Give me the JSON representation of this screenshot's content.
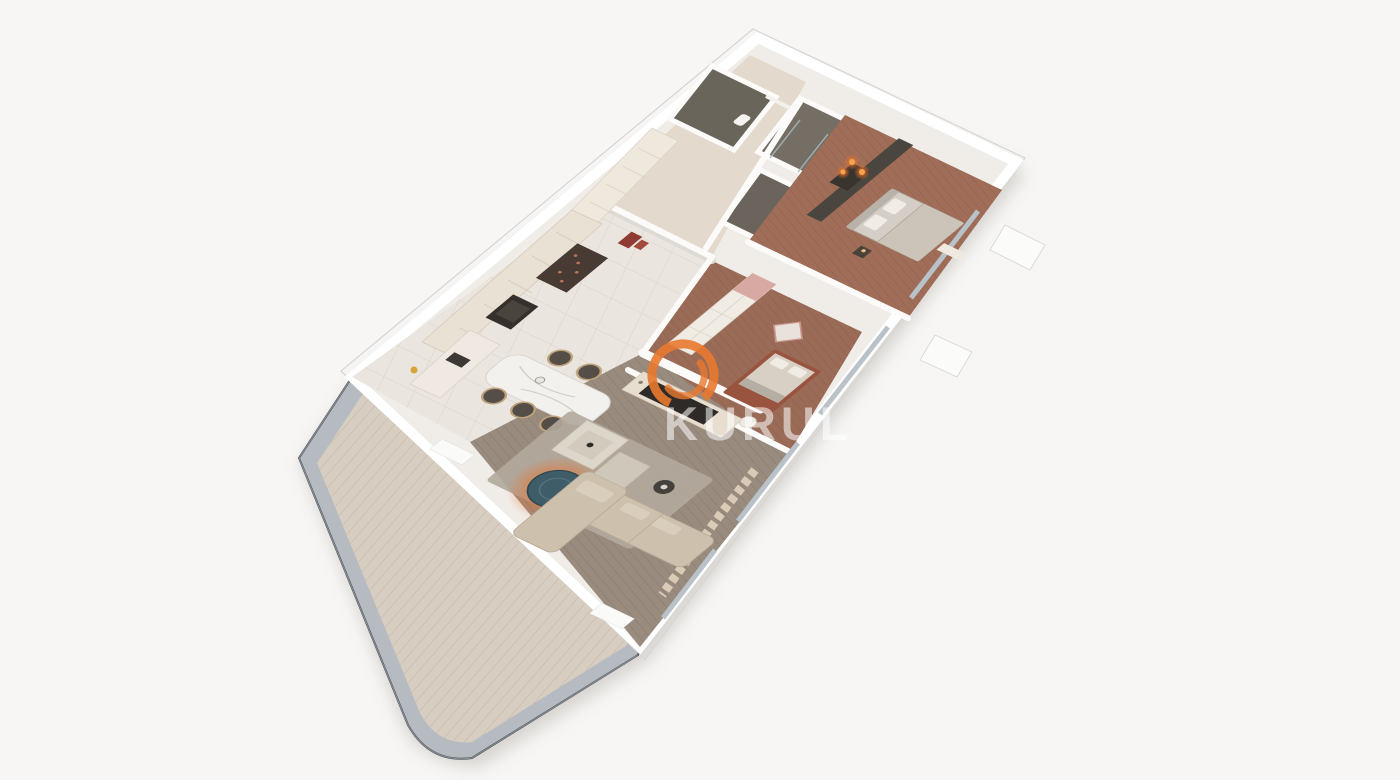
{
  "meta": {
    "description": "3D aerial cutaway render of an apartment floor plan with terrace",
    "background": "#f7f6f4"
  },
  "watermark": {
    "text": "KURUL",
    "logo_color": "#e8792f",
    "text_color": "rgba(255,255,255,0.55)"
  },
  "palette": {
    "outer_wall": "#ffffff",
    "wall_edge": "#d8d5d0",
    "terrace_deck": "#d7cdc0",
    "terrace_railing": "#b6bbc1",
    "kitchen_tile": "#eae5de",
    "living_wood": "#998b7e",
    "bedroom_wood": "#a06e58",
    "bathroom_tile": "#6a655b",
    "hallway_floor": "#e3dacd",
    "cabinet_cream": "#e9e1d4",
    "sofa_beige": "#cdc1ae",
    "accent_glow_orange": "#e8792f",
    "round_rug_teal": "#3f5d68",
    "bed_frame_terracotta": "#99543f"
  },
  "scene": {
    "rooms": [
      {
        "name": "entry-hallway"
      },
      {
        "name": "bathroom"
      },
      {
        "name": "shower-room"
      },
      {
        "name": "utility-room"
      },
      {
        "name": "master-bedroom"
      },
      {
        "name": "second-bedroom"
      },
      {
        "name": "kitchen-dining"
      },
      {
        "name": "living-room"
      },
      {
        "name": "terrace"
      }
    ],
    "furniture": [
      "kitchen-cabinets",
      "oven",
      "wine-cabinet",
      "counter-sink",
      "dining-table",
      "dining-chairs",
      "tv-media-wall",
      "sectional-sofa",
      "coffee-tables",
      "round-rug",
      "area-rug",
      "double-bed-master",
      "pendant-lights",
      "wardrobe",
      "double-bed-second",
      "wall-art",
      "toilet",
      "washbasin",
      "luggage"
    ]
  }
}
